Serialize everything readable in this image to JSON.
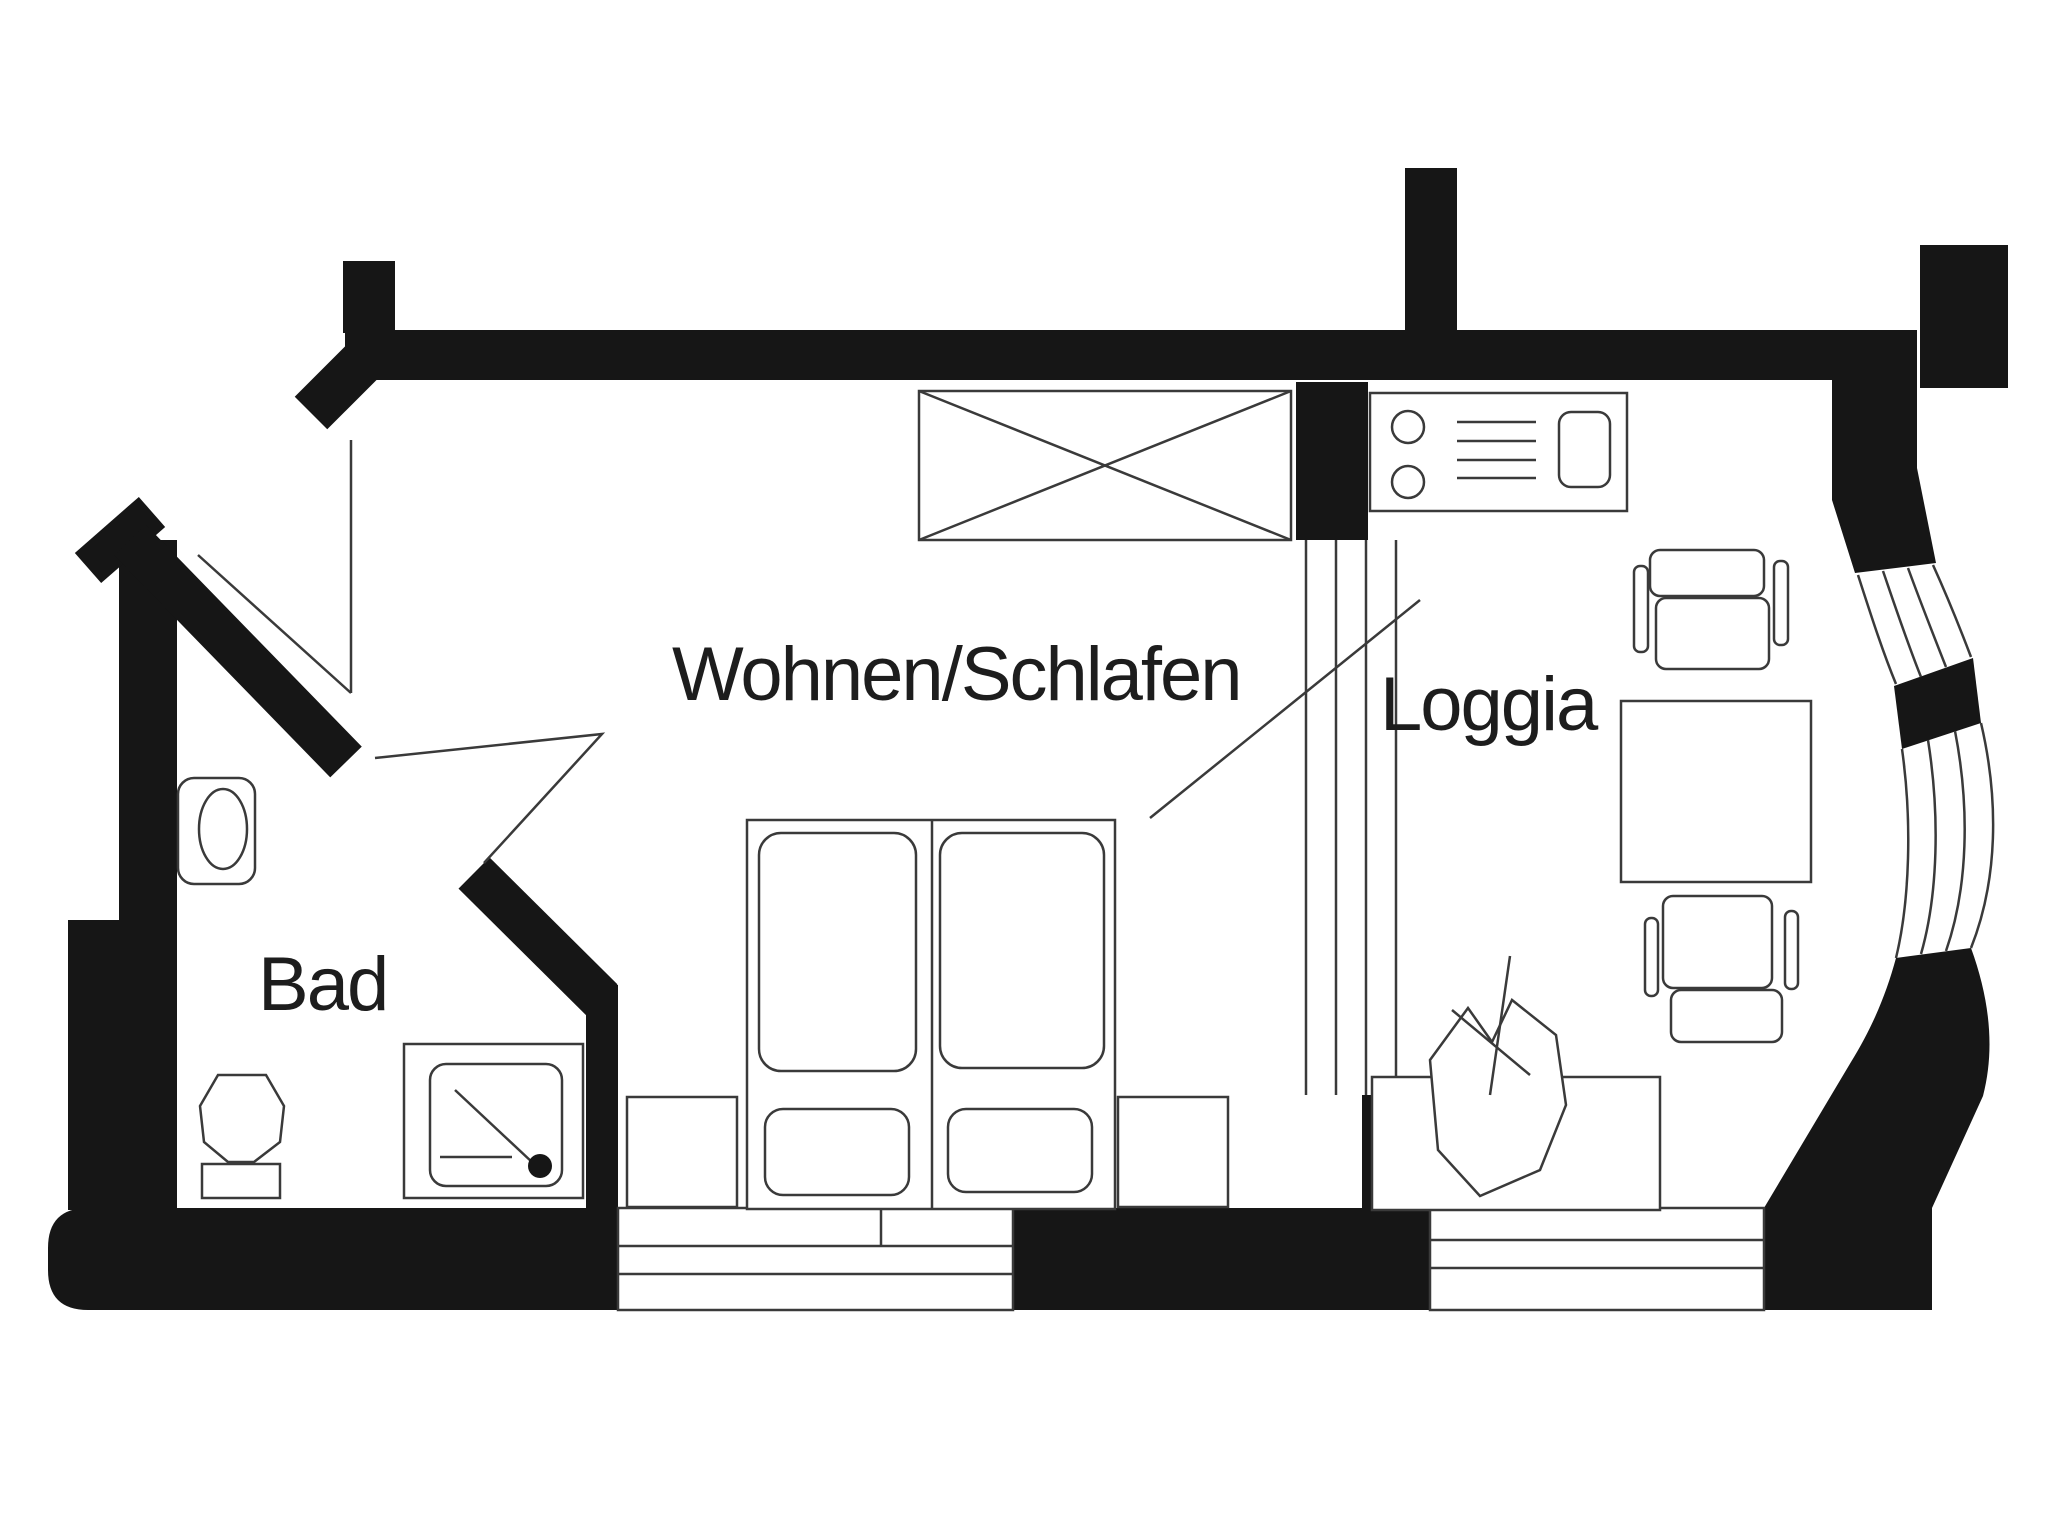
{
  "document": {
    "type": "floor-plan",
    "background": "#ffffff"
  },
  "rooms": [
    {
      "id": "wohnen-schlafen",
      "label": "Wohnen/Schlafen"
    },
    {
      "id": "loggia",
      "label": "Loggia"
    },
    {
      "id": "bad",
      "label": "Bad"
    }
  ],
  "icons": [
    "wardrobe-icon",
    "stove-icon",
    "kitchen-sink-icon",
    "double-bed-icon",
    "nightstand-icon",
    "bath-sink-icon",
    "toilet-icon",
    "shower-icon",
    "table-icon",
    "chair-icon",
    "plant-icon",
    "window-icon",
    "door-swing-icon"
  ],
  "colors": {
    "wall": "#161616",
    "line": "#3a3a3a",
    "text": "#1d1d1d",
    "background": "#ffffff"
  }
}
